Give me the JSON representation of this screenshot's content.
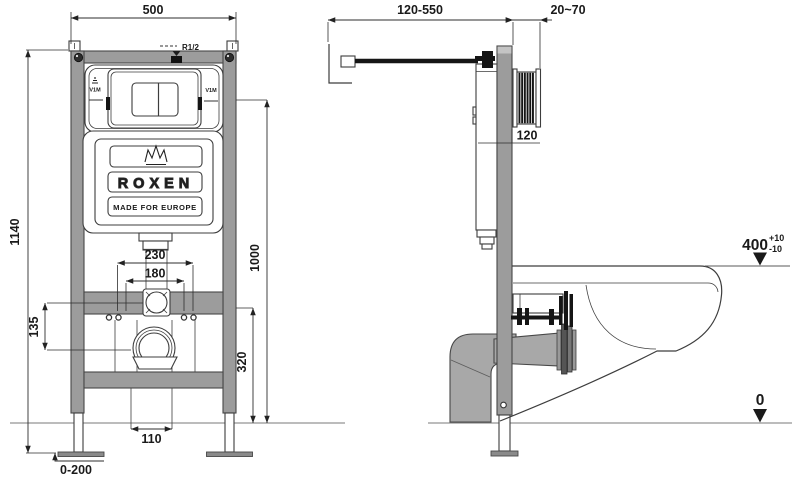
{
  "drawing": {
    "brand": "ROXEN",
    "tagline": "MADE FOR EUROPE",
    "labels": {
      "frame_width": "500",
      "frame_height": "1140",
      "inlet_thread": "R1/2",
      "v1m_left": "V1M",
      "v1m_right": "V1M",
      "bolt_outer": "230",
      "bolt_inner": "180",
      "inlet_drain_offset": "135",
      "plate_center_height": "1000",
      "drain_outlet_height": "320",
      "drain_pipe": "110",
      "foot_adjust": "0-200",
      "rod_range": "120-550",
      "wall_finish": "20~70",
      "plate_depth": "120",
      "bowl_height": "400",
      "tol_plus": "+10",
      "tol_minus": "-10",
      "floor_level": "0"
    }
  }
}
